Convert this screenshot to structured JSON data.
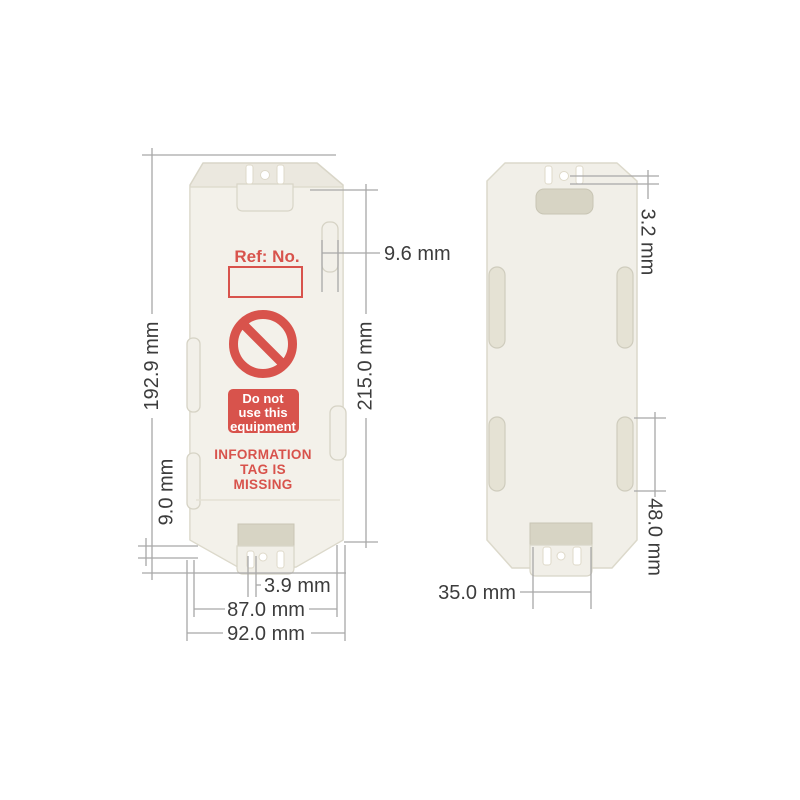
{
  "diagram": {
    "description_colors": {
      "label_red": "#d8534c",
      "plate_offwhite": "#f2f0e9",
      "dimension_line_gray": "#a8a8a8",
      "dimension_text_gray": "#3c3c3c"
    },
    "front_tag": {
      "ref_label": "Ref: No.",
      "warning_sign_lines": [
        "Do not",
        "use this",
        "equipment"
      ],
      "status_lines": [
        "INFORMATION",
        "TAG IS",
        "MISSING"
      ]
    },
    "dimensions": {
      "front_height": "192.9 mm",
      "overall_length": "215.0 mm",
      "side_clip_width": "9.6 mm",
      "bottom_lip_height": "9.0 mm",
      "tie_slot_width": "3.9 mm",
      "inner_width": "87.0 mm",
      "overall_width": "92.0 mm",
      "back_tab_width": "35.0 mm",
      "back_slot_length": "48.0 mm",
      "hole_diameter": "3.2 mm"
    }
  }
}
